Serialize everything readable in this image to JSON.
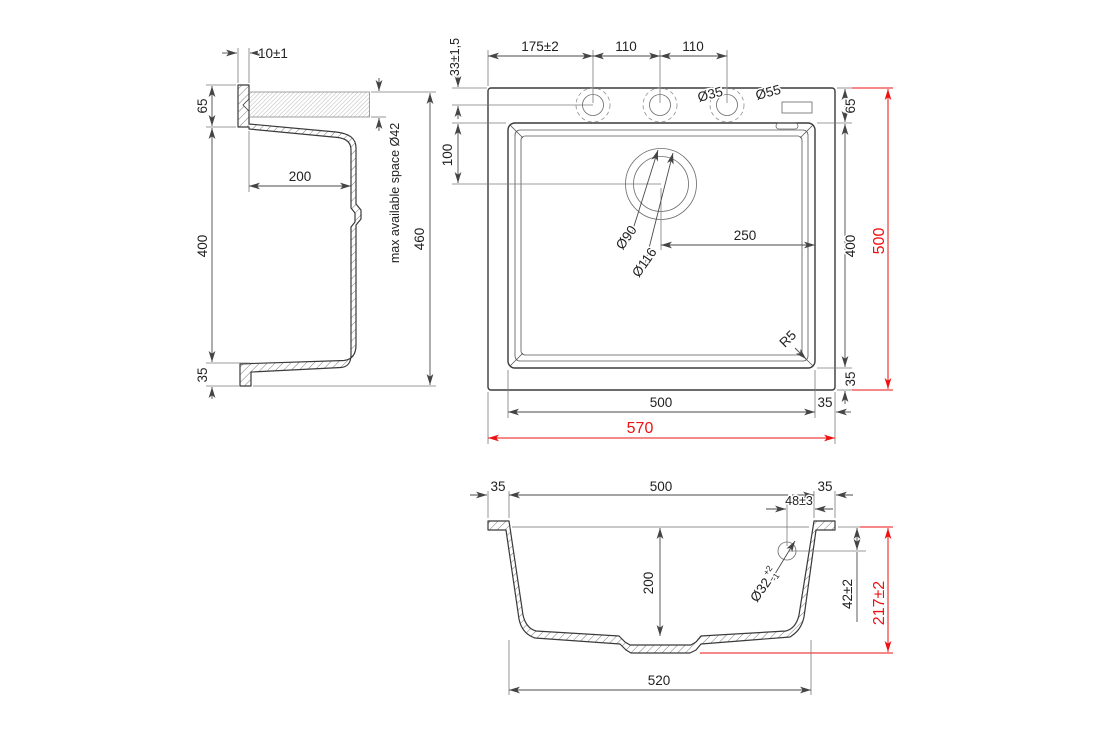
{
  "meta": {
    "type": "technical-drawing",
    "subject": "kitchen sink dimensional drawing, three orthographic views",
    "line_color": "#3a3a3a",
    "accent_red": "#ee1111"
  },
  "a": {
    "thickness": "10±1",
    "front": "65",
    "inner": "200",
    "depth": "400",
    "flange": "35",
    "overall": "460",
    "tapspace": "max available space Ø42"
  },
  "b": {
    "tap_edge": "33±1,5",
    "tap_first": "175±2",
    "tap_p1": "110",
    "tap_p2": "110",
    "d35": "Ø35",
    "d55": "Ø55",
    "deck": "65",
    "drain_edge": "100",
    "d90": "Ø90",
    "d116": "Ø116",
    "drain_x": "250",
    "bowl_l": "400",
    "overall_l": "500",
    "r5": "R5",
    "rear": "35",
    "bowl_w": "500",
    "side": "35",
    "overall_w": "570"
  },
  "c": {
    "rim_l": "35",
    "bowl": "500",
    "rim_r": "35",
    "overflow_x": "48±3",
    "d32": "Ø32",
    "d32p": "+2",
    "d32m": "-1",
    "depth": "200",
    "overflow_y": "42±2",
    "overall": "217±2",
    "base": "520"
  }
}
